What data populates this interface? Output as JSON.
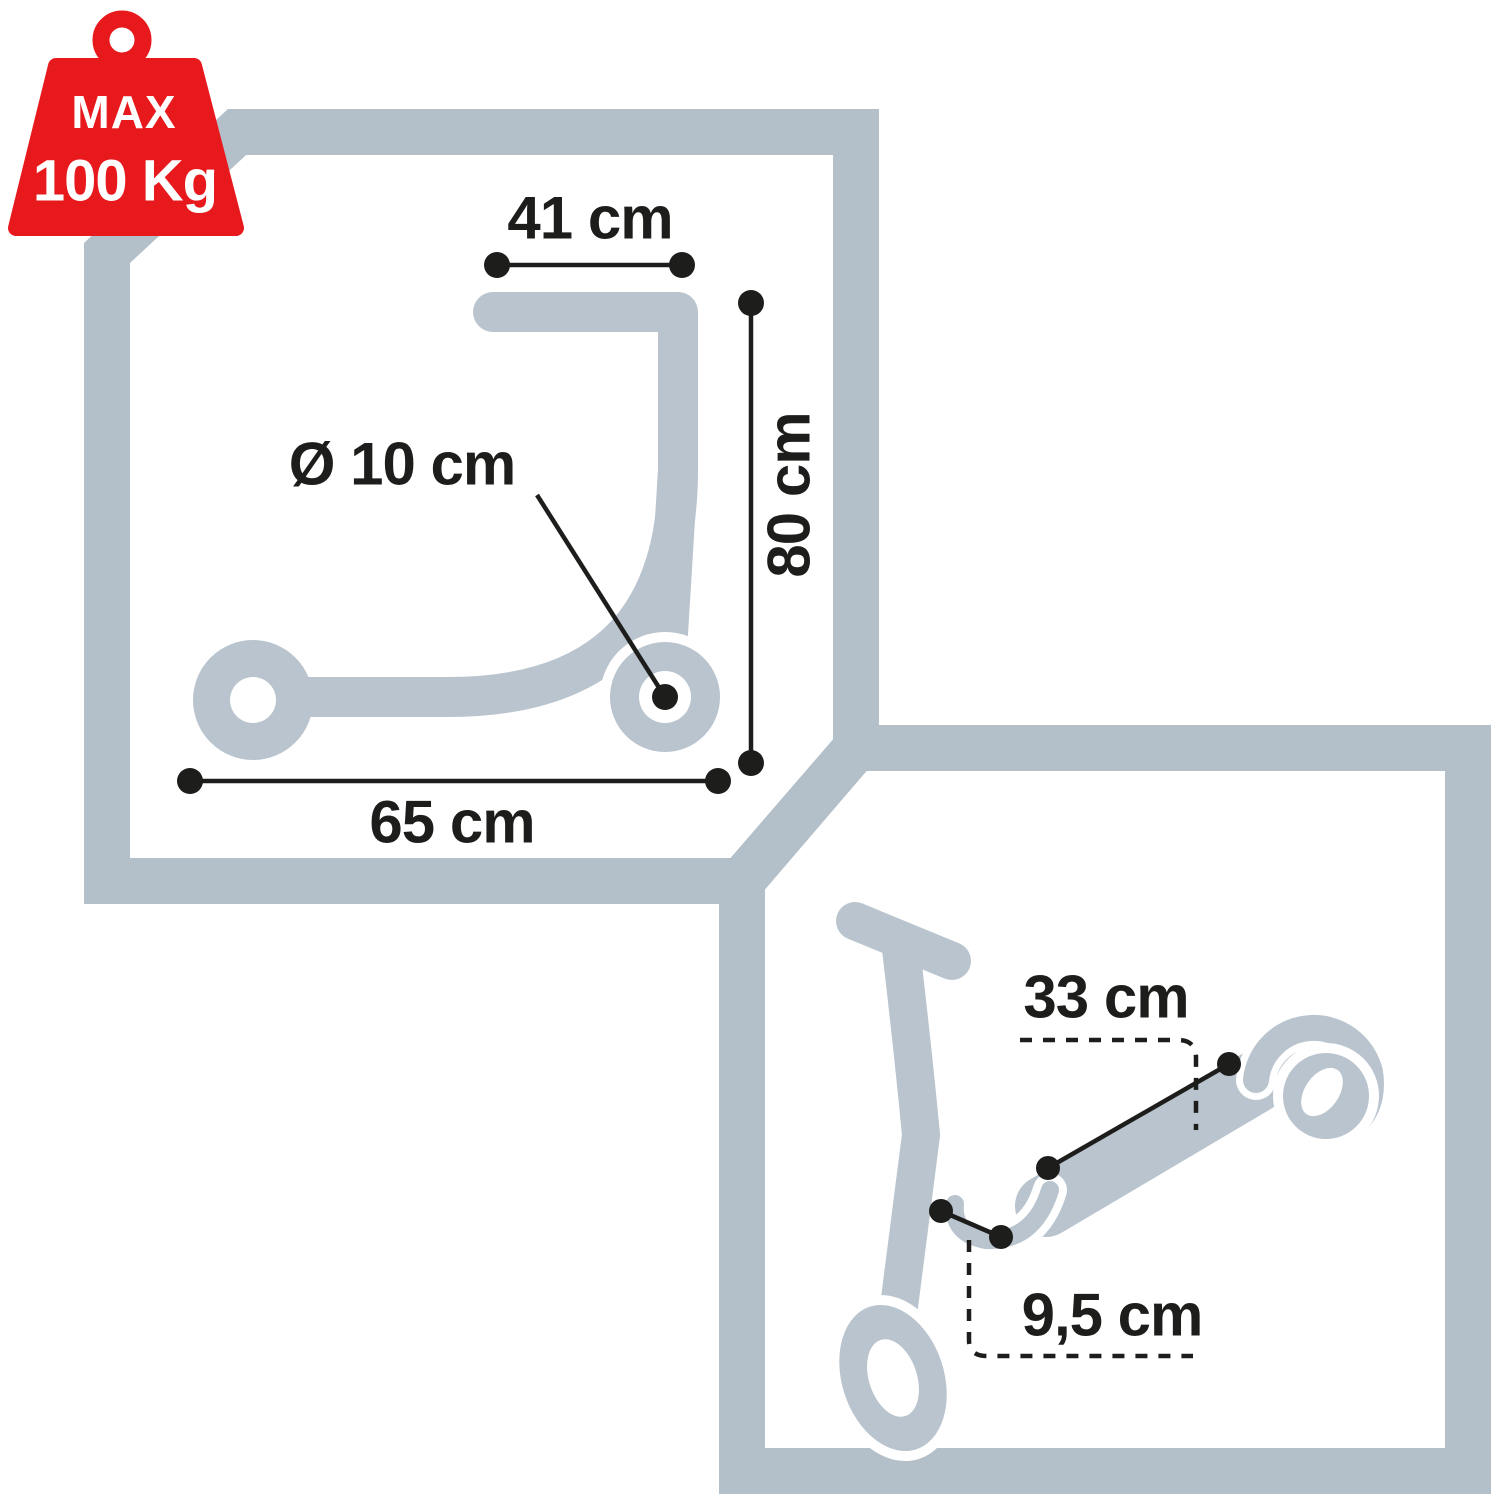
{
  "badge": {
    "line1": "MAX",
    "line2": "100 Kg"
  },
  "panels": {
    "unfolded": {
      "labels": {
        "handlebar_width": "41 cm",
        "wheel_diameter": "Ø 10 cm",
        "height": "80 cm",
        "length": "65 cm"
      }
    },
    "folded": {
      "labels": {
        "folded_deck_length": "33 cm",
        "folded_clearance": "9,5 cm"
      }
    }
  },
  "colors": {
    "accent_red": "#e8191d",
    "frame_gray": "#b3bfc9",
    "silhouette_gray": "#b9c4ce",
    "ink": "#1d1d1b"
  }
}
